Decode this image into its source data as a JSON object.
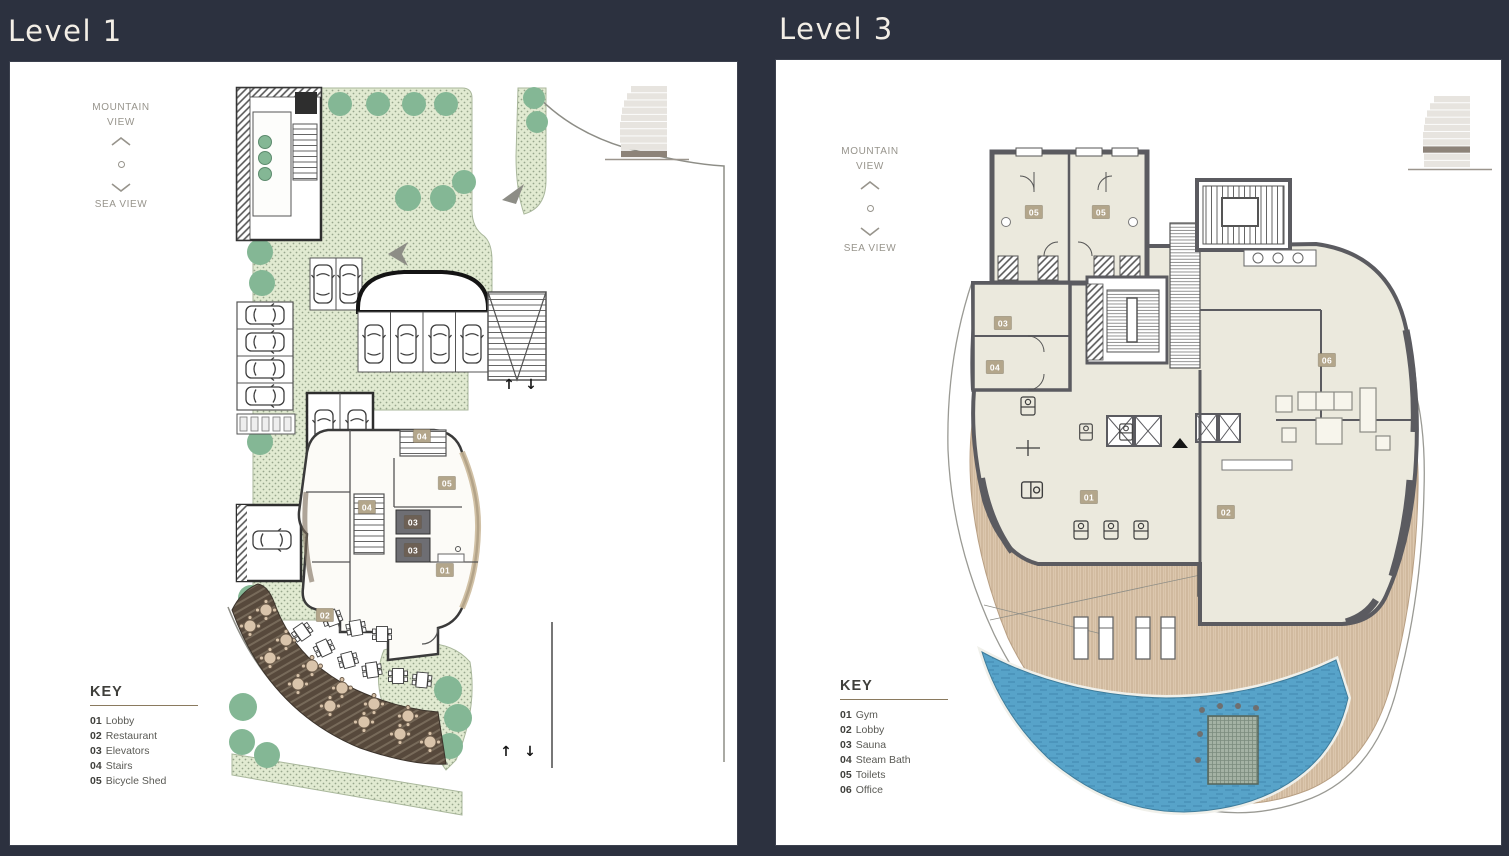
{
  "colors": {
    "background": "#2c313f",
    "panel_white": "#ffffff",
    "landscape_green": "#e1ead1",
    "tree_green": "#84b795",
    "pool_blue": "#57a3c9",
    "deck_wood_tan": "#dcc7ae",
    "terrace_deck_dark": "#57493c",
    "wall_gray": "#5b5b60",
    "floor_cream": "#ebe9dd",
    "badge_tan": "#b3a68b",
    "badge_dark": "#6d6055",
    "title_text": "#f3eee6"
  },
  "icons": {
    "compass_up": "chevron-up-icon",
    "compass_down": "chevron-down-icon",
    "compass_center": "dot-icon",
    "building": "building-elevation-icon"
  },
  "panels": [
    {
      "title": "Level 1",
      "compass": {
        "top1": "MOUNTAIN",
        "top2": "VIEW",
        "bottom": "SEA VIEW"
      },
      "key": {
        "heading": "KEY",
        "items": [
          {
            "code": "01",
            "label": "Lobby"
          },
          {
            "code": "02",
            "label": "Restaurant"
          },
          {
            "code": "03",
            "label": "Elevators"
          },
          {
            "code": "04",
            "label": "Stairs"
          },
          {
            "code": "05",
            "label": "Bicycle Shed"
          }
        ]
      },
      "room_labels": [
        {
          "num": "04",
          "x": 412,
          "y": 374,
          "dark": false
        },
        {
          "num": "04",
          "x": 357,
          "y": 445,
          "dark": false
        },
        {
          "num": "03",
          "x": 403,
          "y": 460,
          "dark": true
        },
        {
          "num": "03",
          "x": 403,
          "y": 488,
          "dark": true
        },
        {
          "num": "05",
          "x": 437,
          "y": 421,
          "dark": false
        },
        {
          "num": "01",
          "x": 435,
          "y": 508,
          "dark": false
        },
        {
          "num": "02",
          "x": 315,
          "y": 553,
          "dark": false
        }
      ],
      "stair_arrows": [
        {
          "glyph": "↑",
          "x": 499,
          "y": 323
        },
        {
          "glyph": "↓",
          "x": 521,
          "y": 323
        },
        {
          "glyph": "↑",
          "x": 496,
          "y": 690
        },
        {
          "glyph": "↓",
          "x": 520,
          "y": 690
        }
      ],
      "building_icon": {
        "floors": 10,
        "highlighted_floor_from_bottom": 1
      }
    },
    {
      "title": "Level 3",
      "compass": {
        "top1": "MOUNTAIN",
        "top2": "VIEW",
        "bottom": "SEA VIEW"
      },
      "key": {
        "heading": "KEY",
        "items": [
          {
            "code": "01",
            "label": "Gym"
          },
          {
            "code": "02",
            "label": "Lobby"
          },
          {
            "code": "03",
            "label": "Sauna"
          },
          {
            "code": "04",
            "label": "Steam Bath"
          },
          {
            "code": "05",
            "label": "Toilets"
          },
          {
            "code": "06",
            "label": "Office"
          }
        ]
      },
      "room_labels": [
        {
          "num": "05",
          "x": 258,
          "y": 152,
          "dark": false
        },
        {
          "num": "05",
          "x": 325,
          "y": 152,
          "dark": false
        },
        {
          "num": "03",
          "x": 227,
          "y": 263,
          "dark": false
        },
        {
          "num": "04",
          "x": 219,
          "y": 307,
          "dark": false
        },
        {
          "num": "06",
          "x": 551,
          "y": 300,
          "dark": false
        },
        {
          "num": "01",
          "x": 313,
          "y": 437,
          "dark": false
        },
        {
          "num": "02",
          "x": 450,
          "y": 452,
          "dark": false
        }
      ],
      "stair_arrows": [],
      "building_icon": {
        "floors": 10,
        "highlighted_floor_from_bottom": 3
      }
    }
  ]
}
